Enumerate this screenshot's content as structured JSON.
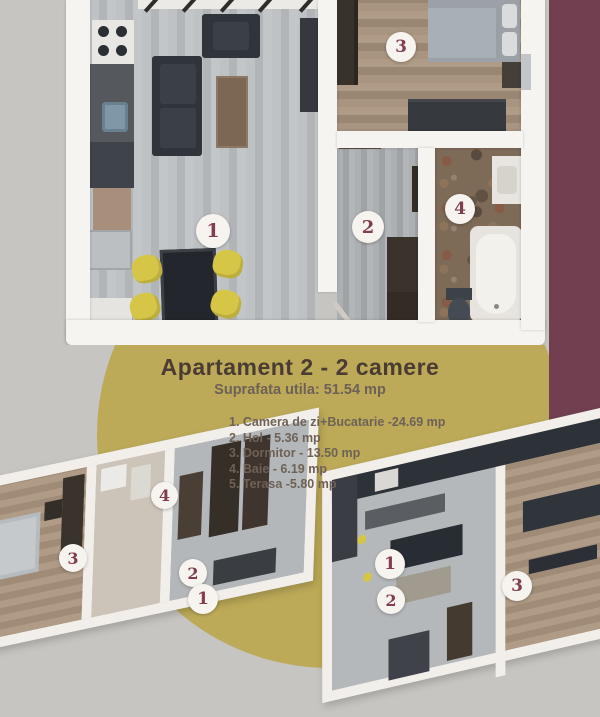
{
  "flyer": {
    "title": "Apartament 2  - 2 camere",
    "subtitle": "Suprafata utila: 51.54 mp",
    "rooms": [
      "1. Camera de zi+Bucatarie -24.69 mp",
      "2. Hol - 5.36 mp",
      "3. Dormitor - 13.50 mp",
      "4. Baie - 6.19 mp",
      "5. Terasa -5.80 mp"
    ]
  },
  "colors": {
    "background_gray": "#c6c5c1",
    "accent_maroon": "#713f50",
    "accent_olive": "#bcaa58",
    "badge_text": "#823d50"
  },
  "plan_main": {
    "badges": {
      "living": "1",
      "hall": "2",
      "bedroom": "3",
      "bath": "4"
    }
  },
  "plan_small_left": {
    "badges": {
      "bath": "4",
      "bedroom": "3",
      "hall": "2",
      "living": "1"
    }
  },
  "plan_small_right": {
    "badges": {
      "living": "1",
      "bedroom": "3",
      "hall": "2"
    }
  }
}
